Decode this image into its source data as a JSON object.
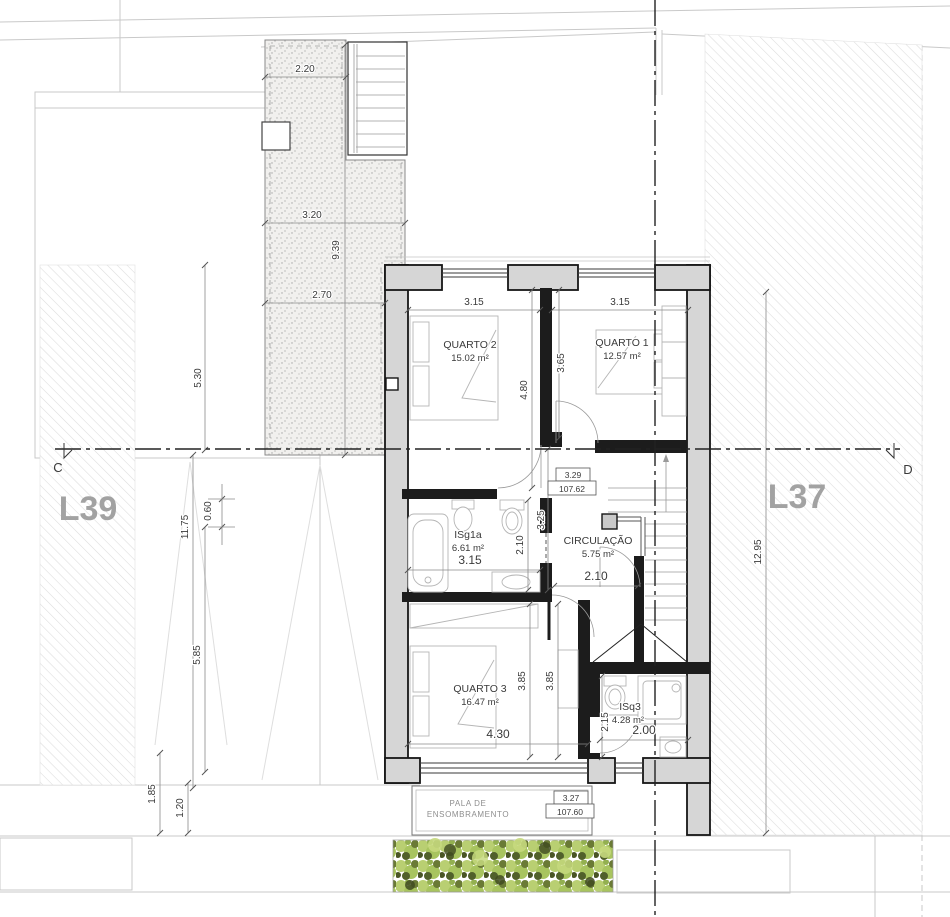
{
  "plan": {
    "plots": {
      "left": "L39",
      "right": "L37"
    },
    "sections": {
      "left": "C",
      "right": "D"
    },
    "rooms": {
      "quarto2": {
        "name": "QUARTO 2",
        "area": "15.02 m²",
        "width": "3.15",
        "depth": "4.80"
      },
      "quarto1": {
        "name": "QUARTO 1",
        "area": "12.57 m²",
        "width": "3.15",
        "depth": "3.65"
      },
      "isg1a": {
        "name": "ISg1a",
        "area": "6.61 m²",
        "width": "3.15",
        "depth": "2.10"
      },
      "circulacao": {
        "name": "CIRCULAÇÃO",
        "area": "5.75 m²",
        "width": "2.10",
        "depth": "3.25"
      },
      "quarto3": {
        "name": "QUARTO 3",
        "area": "16.47 m²",
        "width": "4.30",
        "depth_a": "3.85",
        "depth_b": "3.85"
      },
      "isq3": {
        "name": "ISq3",
        "area": "4.28 m²",
        "width": "2.00",
        "depth": "2.15"
      }
    },
    "site_dims": {
      "terrace_top": "2.20",
      "terrace_mid": "3.20",
      "terrace_low": "2.70",
      "terrace_len": "9.39",
      "left_upper": "5.30",
      "left_total": "11.75",
      "left_offset": "0.60",
      "left_lower": "5.85",
      "bottom_a": "1.85",
      "bottom_b": "1.20",
      "right_depth": "12.95"
    },
    "levels": {
      "floor": {
        "h": "3.29",
        "abs": "107.62"
      },
      "canopy": {
        "h": "3.27",
        "abs": "107.60"
      }
    },
    "canopy": {
      "label_line1": "PALA DE",
      "label_line2": "ENSOMBRAMENTO"
    },
    "colors": {
      "wall_fill": "#d6d6d6",
      "interior_wall": "#1c1c1c",
      "hedge_light": "#b9cf72",
      "hedge_dark": "#4e5b28"
    }
  }
}
